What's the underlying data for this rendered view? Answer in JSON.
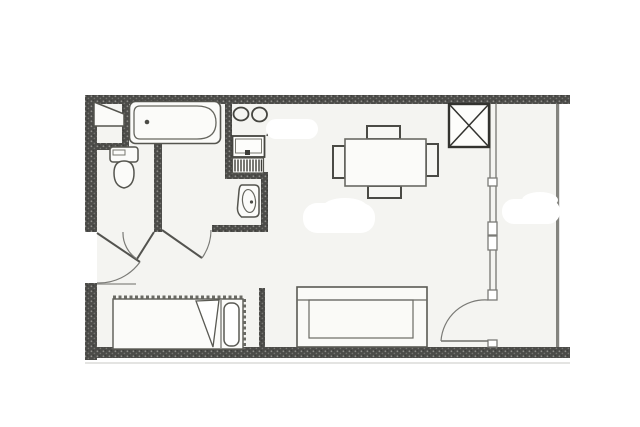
{
  "document": {
    "kind": "scanned architectural floor plan",
    "description": "studio apartment plan with bathroom, toilet, kitchenette, living area and balcony",
    "visible_text": "",
    "colors": {
      "paper": "#ffffff",
      "floor": "#f4f4f1",
      "wall_dark": "#4c4c49",
      "wall_speck": "#908f8b",
      "line": "#53534f",
      "light_line": "#8d8d89",
      "arc": "#7a7a76"
    }
  },
  "fixtures": [
    {
      "name": "entry-closet",
      "shape": "slanted wardrobe, top-left corner"
    },
    {
      "name": "bathtub",
      "shape": "rounded tub with drain dot, top wall"
    },
    {
      "name": "toilet",
      "shape": "tank + bowl, left room"
    },
    {
      "name": "washbasin",
      "shape": "oval basin on right wall of bathroom"
    },
    {
      "name": "cooktop-two-burners",
      "shape": "two circles, kitchen niche"
    },
    {
      "name": "kitchen-sink-with-drainboard",
      "shape": "rect sink + striped drainboard"
    },
    {
      "name": "dining-table",
      "shape": "rectangle with four chairs"
    },
    {
      "name": "shaft-x-box",
      "shape": "square crossed with X, top of living room"
    },
    {
      "name": "sofa",
      "shape": "three-part sofa on bottom wall"
    },
    {
      "name": "single-bed",
      "shape": "bed with scalloped blanket edge, folded corner and pillow"
    }
  ],
  "doors": [
    {
      "name": "entry-door",
      "location": "left exterior wall, swings into hall"
    },
    {
      "name": "toilet-door",
      "location": "hall, swings left"
    },
    {
      "name": "bathroom-door",
      "location": "hall, swings right"
    },
    {
      "name": "balcony-door",
      "location": "window wall bottom, swings into living room"
    }
  ],
  "windows": [
    {
      "name": "window-wall",
      "location": "full-height glazing between living room and balcony"
    }
  ],
  "artifacts": [
    {
      "name": "white-out-patch",
      "location": "over kitchen right edge"
    },
    {
      "name": "white-out-patch",
      "location": "living room centre"
    },
    {
      "name": "white-out-patch",
      "location": "balcony middle"
    },
    {
      "name": "white-out-patch",
      "location": "left margin at entry"
    }
  ]
}
